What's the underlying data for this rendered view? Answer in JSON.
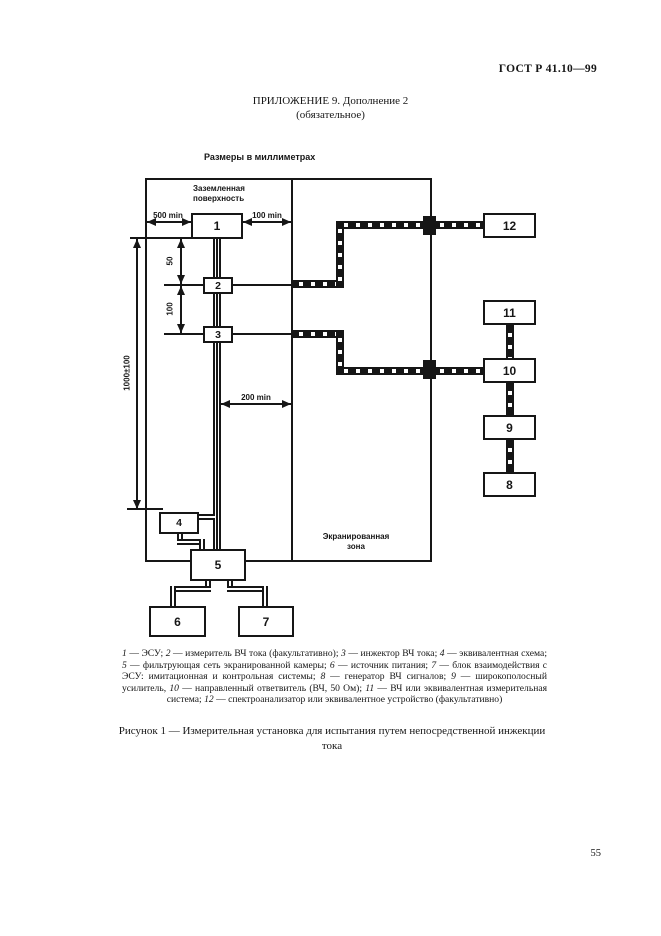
{
  "page": {
    "gost_number": "ГОСТ Р 41.10—99",
    "appendix_title": "ПРИЛОЖЕНИЕ 9. Дополнение 2",
    "appendix_subtitle": "(обязательное)",
    "page_number": "55"
  },
  "figure": {
    "units_note": "Размеры в миллиметрах",
    "labels": {
      "grounded_surface_line1": "Заземленная",
      "grounded_surface_line2": "поверхность",
      "shielded_zone_line1": "Экранированная",
      "shielded_zone_line2": "зона"
    },
    "dims": {
      "left_min": "500 min",
      "right_min": "100 min",
      "probe_gap_1": "50",
      "probe_gap_2": "100",
      "harness_length": "1000±100",
      "zone_gap": "200 min"
    },
    "boxes": {
      "b1": "1",
      "b2": "2",
      "b3": "3",
      "b4": "4",
      "b5": "5",
      "b6": "6",
      "b7": "7",
      "b8": "8",
      "b9": "9",
      "b10": "10",
      "b11": "11",
      "b12": "12"
    }
  },
  "legend": {
    "items": [
      {
        "n": "1",
        "t": " — ЭСУ; "
      },
      {
        "n": "2",
        "t": " — измеритель ВЧ тока (факультативно); "
      },
      {
        "n": "3",
        "t": " — инжектор ВЧ тока; "
      },
      {
        "n": "4",
        "t": " — эквивалентная схема; "
      },
      {
        "n": "5",
        "t": " — фильтрующая сеть экранированной камеры; "
      },
      {
        "n": "6",
        "t": " — источник питания; "
      },
      {
        "n": "7",
        "t": " — блок взаимодействия с ЭСУ: имитационная и контрольная системы; "
      },
      {
        "n": "8",
        "t": " — генератор ВЧ сигналов; "
      },
      {
        "n": "9",
        "t": " — широкополосный усилитель, "
      },
      {
        "n": "10",
        "t": " — направленный ответвитель (ВЧ, 50 Ом); "
      },
      {
        "n": "11",
        "t": " — ВЧ или эквивалентная измерительная система; "
      },
      {
        "n": "12",
        "t": " — спектроанализатор или эквивалентное устройство (факультативно)"
      }
    ]
  },
  "caption": "Рисунок 1 — Измерительная установка для испытания путем непосредственной инжекции тока"
}
